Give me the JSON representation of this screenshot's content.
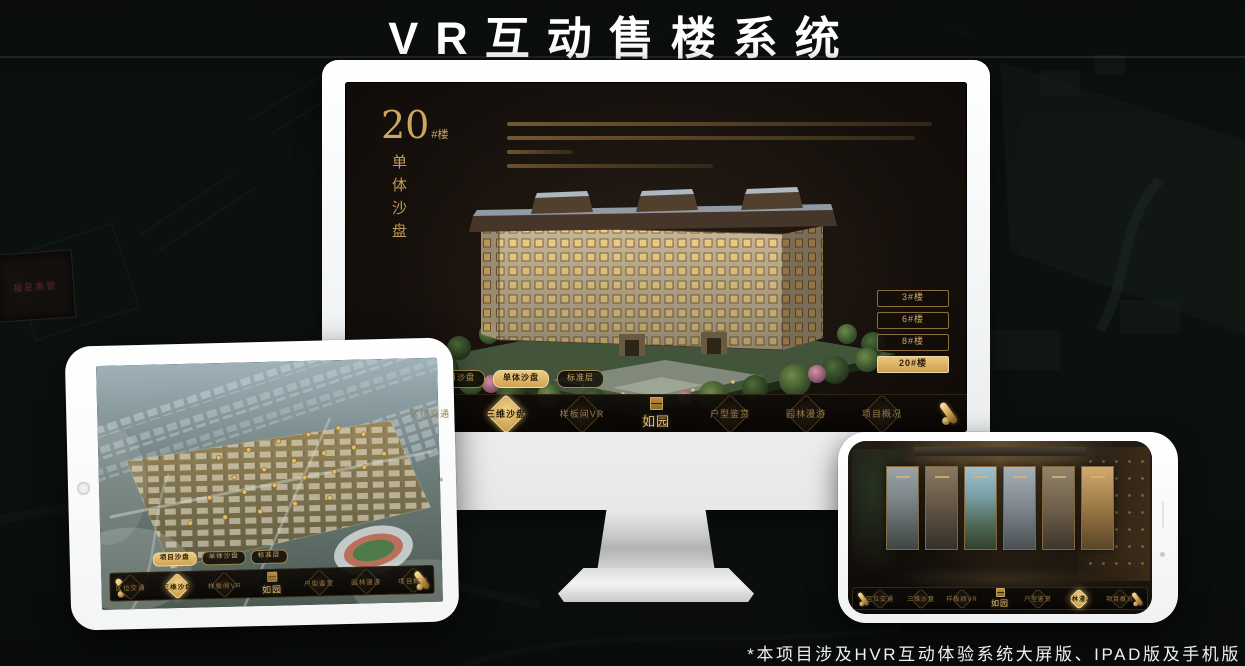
{
  "page": {
    "title": "VR互动售楼系统",
    "footnote": "*本项目涉及HVR互动体验系统大屏版、IPAD版及手机版"
  },
  "background": {
    "plaque_text": "福星惠誉"
  },
  "colors": {
    "gold": "#d2ab62",
    "gold_active": "#e2bd74",
    "screen_bg": "#17110d"
  },
  "desktop": {
    "heading": {
      "number": "20",
      "suffix": "#楼",
      "vertical": "单体沙盘"
    },
    "floor_buttons": [
      {
        "label": "3#楼",
        "active": false
      },
      {
        "label": "6#楼",
        "active": false
      },
      {
        "label": "8#楼",
        "active": false
      },
      {
        "label": "20#楼",
        "active": true
      }
    ],
    "subtabs": [
      {
        "label": "项目沙盘",
        "active": false
      },
      {
        "label": "单体沙盘",
        "active": true
      },
      {
        "label": "标准层",
        "active": false
      }
    ],
    "nav": {
      "logo": "如园",
      "items": [
        {
          "label": "区位交通",
          "active": false
        },
        {
          "label": "三维沙盘",
          "active": true
        },
        {
          "label": "样板间VR",
          "active": false
        },
        {
          "label": "户型鉴赏",
          "active": false
        },
        {
          "label": "园林漫游",
          "active": false
        },
        {
          "label": "项目概况",
          "active": false
        }
      ]
    }
  },
  "tablet": {
    "subtabs": [
      {
        "label": "项目沙盘",
        "active": true
      },
      {
        "label": "单体沙盘",
        "active": false
      },
      {
        "label": "标准层",
        "active": false
      }
    ],
    "nav": {
      "logo": "如园",
      "items": [
        {
          "label": "区位交通",
          "active": false
        },
        {
          "label": "三维沙盘",
          "active": true
        },
        {
          "label": "样板间VR",
          "active": false
        },
        {
          "label": "户型鉴赏",
          "active": false
        },
        {
          "label": "园林漫游",
          "active": false
        },
        {
          "label": "项目概况",
          "active": false
        }
      ]
    }
  },
  "phone": {
    "nav": {
      "logo": "如园",
      "items": [
        {
          "label": "区位交通",
          "active": false
        },
        {
          "label": "三维沙盘",
          "active": false
        },
        {
          "label": "样板间VR",
          "active": false
        },
        {
          "label": "户型鉴赏",
          "active": false
        },
        {
          "label": "园林漫游",
          "active": true
        },
        {
          "label": "项目概况",
          "active": false
        }
      ]
    }
  }
}
